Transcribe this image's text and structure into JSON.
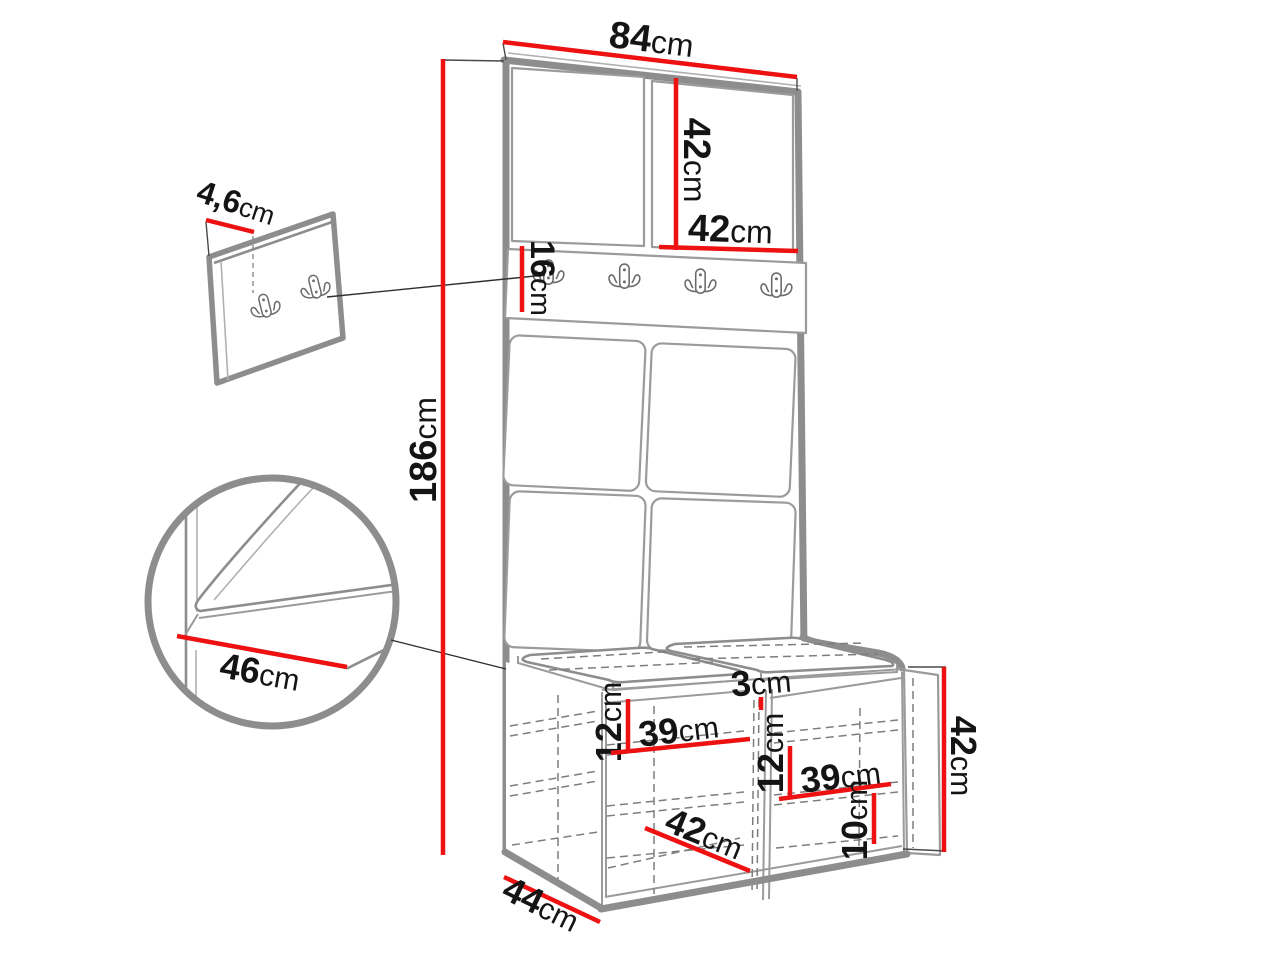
{
  "colors": {
    "dimension_red": "#ee1111",
    "outline_gray": "#8d8d8d",
    "line_gray": "#9b9b9b",
    "dashed_gray": "#7d7d7d",
    "text_black": "#141414",
    "background": "#ffffff"
  },
  "dims": {
    "unit_width": {
      "v": "84",
      "u": "cm"
    },
    "unit_height": {
      "v": "186",
      "u": "cm"
    },
    "door_height": {
      "v": "42",
      "u": "cm"
    },
    "door_width": {
      "v": "42",
      "u": "cm"
    },
    "hook_rail_height": {
      "v": "16",
      "u": "cm"
    },
    "wall_panel_thickness": {
      "v": "4,6",
      "u": "cm"
    },
    "seat_detail_depth": {
      "v": "46",
      "u": "cm"
    },
    "shelf_left_height": {
      "v": "12",
      "u": "cm"
    },
    "shelf_left_width": {
      "v": "39",
      "u": "cm"
    },
    "divider_thickness": {
      "v": "3",
      "u": "cm"
    },
    "shelf_right_height": {
      "v": "12",
      "u": "cm"
    },
    "shelf_right_width": {
      "v": "39",
      "u": "cm"
    },
    "bench_floor_width": {
      "v": "42",
      "u": "cm"
    },
    "bottom_shelf_height": {
      "v": "10",
      "u": "cm"
    },
    "bench_depth": {
      "v": "44",
      "u": "cm"
    },
    "bench_height": {
      "v": "42",
      "u": "cm"
    }
  }
}
